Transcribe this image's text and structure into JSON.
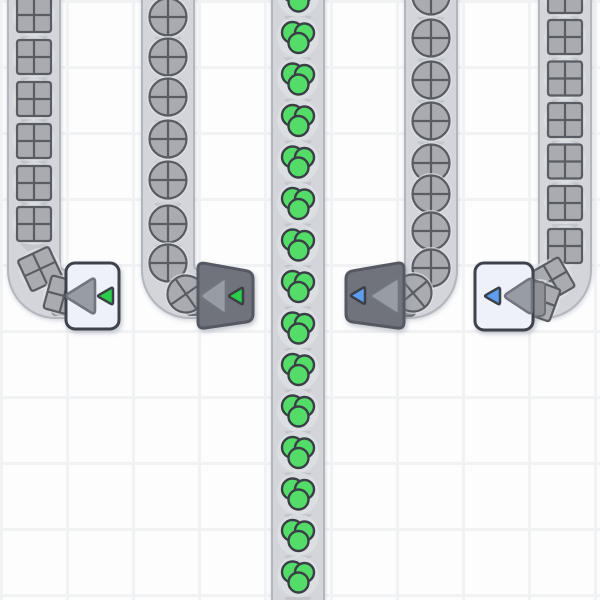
{
  "app": {
    "kind": "factory-automation-game",
    "viewport": "top-down-grid-map"
  },
  "grid": {
    "cell_size": 66,
    "line_color": "#f1f2f4",
    "cell_color": "#fdfdfe"
  },
  "colors": {
    "belt_fill": "#d3d5da",
    "belt_edge": "#b4b6be",
    "belt_chevron": "#c4c6cc",
    "item_halo": "#e0e2e6",
    "item_gray_fill": "#a9abb0",
    "item_gray_outline": "#595c63",
    "resource_green_fill": "#54dc69",
    "resource_green_outline": "#3a3f46",
    "building_light_fill": "#eef1f8",
    "building_light_border": "#3d424b",
    "building_dark_fill": "#6f727c",
    "building_dark_border": "#565962",
    "arrow_fill": "#989da5",
    "arrow_outline": "#71757d",
    "indicator_green": "#2bce48",
    "indicator_blue": "#5b9ef0",
    "indicator_outline": "#3a3f46",
    "nozzle_fill": "#8e9096",
    "nozzle_border": "#6e7076"
  },
  "belts": [
    {
      "name": "belt-line-1",
      "item_type": "quartered-square",
      "flow": "down",
      "bend": "right",
      "x": 8,
      "end_x": 74,
      "items_y": [
        15,
        57,
        99,
        141,
        183,
        224
      ],
      "bend_items": [
        {
          "x": 40,
          "y": 269,
          "rot": -25
        },
        {
          "x": 64,
          "y": 296,
          "rot": -75
        }
      ],
      "chevrons": {
        "from": 36,
        "to": 252,
        "pitch": 41.5
      }
    },
    {
      "name": "belt-line-2",
      "item_type": "quartered-circle",
      "flow": "down",
      "bend": "right",
      "x": 142,
      "end_x": 208,
      "items_y": [
        17,
        57,
        97,
        139,
        180,
        224,
        263
      ],
      "bend_items": [
        {
          "x": 186,
          "y": 294,
          "rot": -35
        }
      ],
      "chevrons": {
        "from": 37,
        "to": 252,
        "pitch": 41.5
      }
    },
    {
      "name": "belt-line-3",
      "item_type": "green-cluster",
      "flow": "down",
      "bend": "none",
      "x": 272,
      "end_x": null,
      "items_y": [
        -4.5,
        37,
        78.5,
        120,
        161.5,
        203,
        244.5,
        286,
        327.5,
        369,
        410.5,
        452,
        493.5,
        535,
        576.5
      ],
      "bend_items": [],
      "chevrons": {
        "from": 16,
        "to": 598,
        "pitch": 41.5
      }
    },
    {
      "name": "belt-line-4",
      "item_type": "quartered-circle",
      "flow": "down",
      "bend": "left",
      "x": 405,
      "end_x": 392,
      "items_y": [
        -4,
        38,
        80,
        121,
        163,
        194,
        231,
        268
      ],
      "bend_items": [
        {
          "x": 413,
          "y": 293,
          "rot": -40
        }
      ],
      "chevrons": {
        "from": 17,
        "to": 180,
        "pitch": 41.5
      }
    },
    {
      "name": "belt-line-5",
      "item_type": "quartered-square",
      "flow": "down",
      "bend": "left",
      "x": 539,
      "end_x": 524,
      "items_y": [
        -4,
        37,
        78.5,
        120,
        161.5,
        203,
        246
      ],
      "bend_items": [
        {
          "x": 552,
          "y": 280,
          "rot": -30
        },
        {
          "x": 539,
          "y": 300,
          "rot": -70
        }
      ],
      "chevrons": {
        "from": 16.5,
        "to": 252,
        "pitch": 41.5
      }
    }
  ],
  "buildings": [
    {
      "name": "launcher-building-1",
      "style": "light",
      "indicator_color": "green",
      "rect": {
        "x": 66,
        "y": 263,
        "w": 53,
        "h": 66
      },
      "arrow": {
        "tip": [
          64.5,
          296
        ],
        "base_x": 95
      },
      "indicator": {
        "tip": [
          97,
          296
        ],
        "base_x": 113
      },
      "nozzle": {
        "x": 52,
        "y": 281,
        "w": 16,
        "h": 34,
        "layer": "under"
      }
    },
    {
      "name": "launcher-building-2",
      "style": "dark",
      "indicator_color": "green",
      "pts": [
        [
          198,
          262
        ],
        [
          253,
          272
        ],
        [
          253,
          321
        ],
        [
          198,
          329
        ]
      ],
      "arrow": {
        "tip": [
          199,
          296
        ],
        "base_x": 226
      },
      "indicator": {
        "tip": [
          228,
          296
        ],
        "base_x": 243
      },
      "nozzle": {
        "x": 186,
        "y": 281,
        "w": 16,
        "h": 34,
        "layer": "under"
      }
    },
    {
      "name": "launcher-building-3",
      "style": "dark",
      "indicator_color": "blue",
      "pts": [
        [
          346,
          272
        ],
        [
          404,
          262
        ],
        [
          404,
          329
        ],
        [
          346,
          321
        ]
      ],
      "arrow": {
        "tip": [
          369,
          296
        ],
        "base_x": 399
      },
      "indicator": {
        "tip": [
          350,
          295.5
        ],
        "base_x": 365
      },
      "nozzle": {
        "x": 398,
        "y": 282,
        "w": 17,
        "h": 34,
        "layer": "under"
      }
    },
    {
      "name": "launcher-building-4",
      "style": "light",
      "indicator_color": "blue",
      "rect": {
        "x": 475,
        "y": 263,
        "w": 58,
        "h": 67
      },
      "arrow": {
        "tip": [
          503,
          296
        ],
        "base_x": 532
      },
      "indicator": {
        "tip": [
          484,
          296
        ],
        "base_x": 500
      },
      "nozzle": {
        "x": 527,
        "y": 282,
        "w": 18,
        "h": 34,
        "layer": "over"
      }
    }
  ]
}
